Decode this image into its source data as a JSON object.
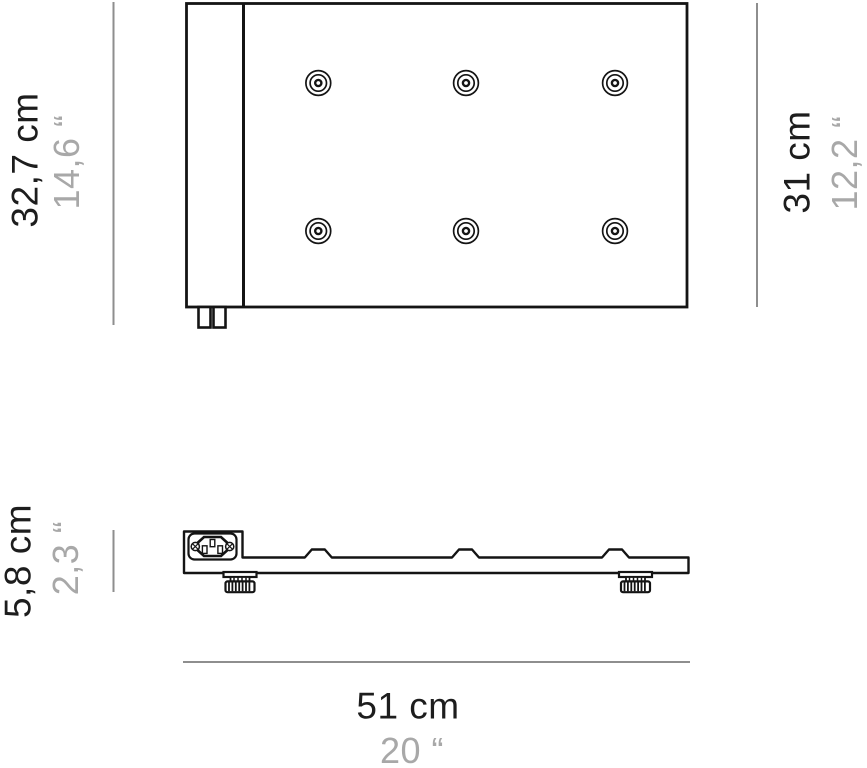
{
  "colors": {
    "background": "#ffffff",
    "line": "#141414",
    "dim_line": "#8e8e8e",
    "text_dark": "#1d1d1d",
    "text_gray": "#a8a8a8"
  },
  "dimensions": {
    "depth_overall": {
      "cm": "32,7 cm",
      "inch": "14,6 “"
    },
    "depth_panel": {
      "cm": "31 cm",
      "inch": "12,2 “"
    },
    "height": {
      "cm": "5,8 cm",
      "inch": "2,3 “"
    },
    "width": {
      "cm": "51 cm",
      "inch": "20 “"
    }
  },
  "views": {
    "top": {
      "name": "top view",
      "screw_holes": 6,
      "rear_tabs": 2
    },
    "side": {
      "name": "side view",
      "power_inlet": "IEC C14 socket",
      "adjustable_feet": 2,
      "mount_bumps": 3
    }
  }
}
